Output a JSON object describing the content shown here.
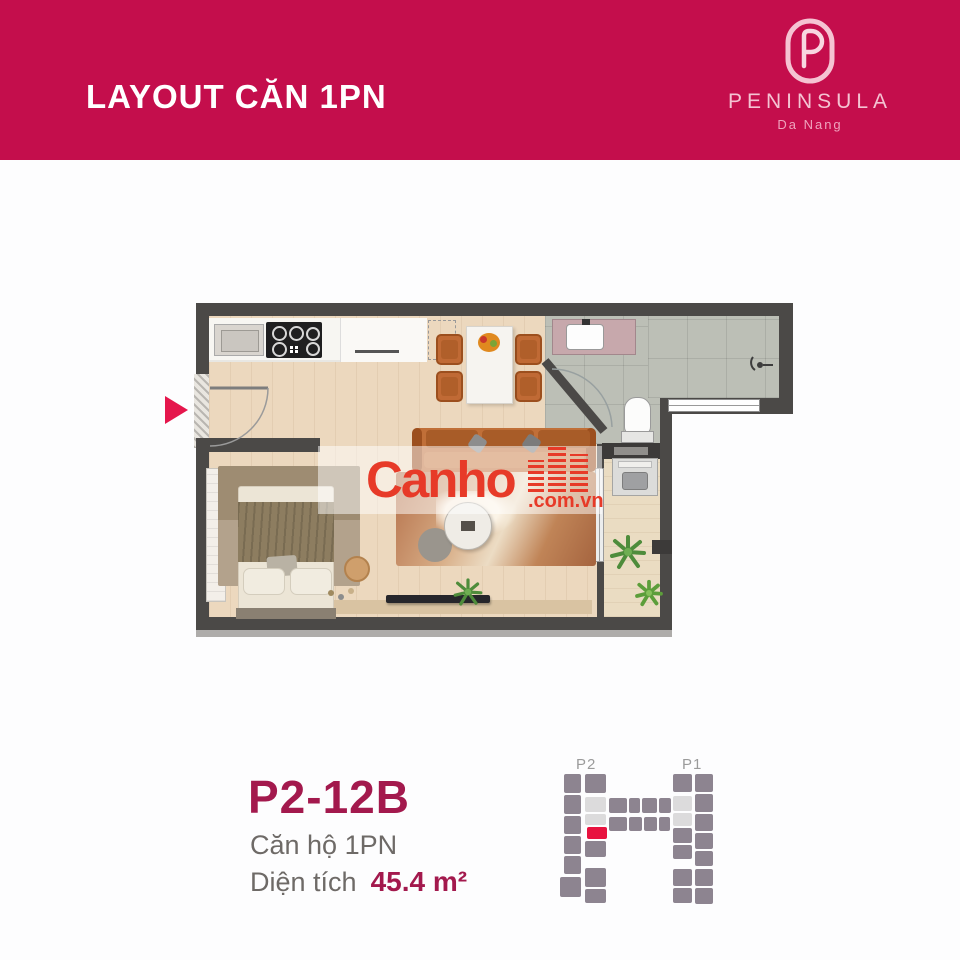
{
  "header": {
    "title": "LAYOUT CĂN 1PN",
    "brand": {
      "name": "PENINSULA",
      "subtitle": "Da Nang"
    }
  },
  "watermark": {
    "brand": "Canho",
    "domain": ".com.vn"
  },
  "unit": {
    "code": "P2-12B",
    "type_label": "Căn hộ 1PN",
    "area_label": "Diện tích",
    "area_value": "45.4 m²"
  },
  "keyplan": {
    "towers": [
      "P2",
      "P1"
    ],
    "blocks": [
      {
        "x": 24,
        "y": 26,
        "w": 17,
        "h": 19,
        "c": "g"
      },
      {
        "x": 24,
        "y": 47,
        "w": 17,
        "h": 19,
        "c": "g"
      },
      {
        "x": 24,
        "y": 68,
        "w": 17,
        "h": 18,
        "c": "g"
      },
      {
        "x": 24,
        "y": 88,
        "w": 17,
        "h": 18,
        "c": "g"
      },
      {
        "x": 24,
        "y": 108,
        "w": 17,
        "h": 18,
        "c": "g"
      },
      {
        "x": 20,
        "y": 129,
        "w": 21,
        "h": 20,
        "c": "g"
      },
      {
        "x": 45,
        "y": 26,
        "w": 21,
        "h": 19,
        "c": "g"
      },
      {
        "x": 45,
        "y": 49,
        "w": 21,
        "h": 15,
        "c": "l"
      },
      {
        "x": 45,
        "y": 66,
        "w": 21,
        "h": 11,
        "c": "l"
      },
      {
        "x": 47,
        "y": 79,
        "w": 20,
        "h": 12,
        "c": "r"
      },
      {
        "x": 45,
        "y": 93,
        "w": 21,
        "h": 16,
        "c": "g"
      },
      {
        "x": 45,
        "y": 120,
        "w": 21,
        "h": 19,
        "c": "g"
      },
      {
        "x": 45,
        "y": 141,
        "w": 21,
        "h": 14,
        "c": "g"
      },
      {
        "x": 69,
        "y": 50,
        "w": 18,
        "h": 15,
        "c": "g"
      },
      {
        "x": 89,
        "y": 50,
        "w": 11,
        "h": 15,
        "c": "g"
      },
      {
        "x": 102,
        "y": 50,
        "w": 15,
        "h": 15,
        "c": "g"
      },
      {
        "x": 119,
        "y": 50,
        "w": 12,
        "h": 15,
        "c": "g"
      },
      {
        "x": 69,
        "y": 69,
        "w": 18,
        "h": 14,
        "c": "g"
      },
      {
        "x": 89,
        "y": 69,
        "w": 13,
        "h": 14,
        "c": "g"
      },
      {
        "x": 104,
        "y": 69,
        "w": 13,
        "h": 14,
        "c": "g"
      },
      {
        "x": 119,
        "y": 69,
        "w": 11,
        "h": 14,
        "c": "g"
      },
      {
        "x": 133,
        "y": 26,
        "w": 19,
        "h": 18,
        "c": "g"
      },
      {
        "x": 133,
        "y": 48,
        "w": 19,
        "h": 15,
        "c": "l"
      },
      {
        "x": 133,
        "y": 65,
        "w": 19,
        "h": 13,
        "c": "l"
      },
      {
        "x": 133,
        "y": 80,
        "w": 19,
        "h": 15,
        "c": "g"
      },
      {
        "x": 133,
        "y": 97,
        "w": 19,
        "h": 14,
        "c": "g"
      },
      {
        "x": 133,
        "y": 121,
        "w": 19,
        "h": 17,
        "c": "g"
      },
      {
        "x": 133,
        "y": 140,
        "w": 19,
        "h": 15,
        "c": "g"
      },
      {
        "x": 155,
        "y": 26,
        "w": 18,
        "h": 18,
        "c": "g"
      },
      {
        "x": 155,
        "y": 46,
        "w": 18,
        "h": 18,
        "c": "g"
      },
      {
        "x": 155,
        "y": 66,
        "w": 18,
        "h": 17,
        "c": "g"
      },
      {
        "x": 155,
        "y": 85,
        "w": 18,
        "h": 16,
        "c": "g"
      },
      {
        "x": 155,
        "y": 103,
        "w": 18,
        "h": 15,
        "c": "g"
      },
      {
        "x": 155,
        "y": 121,
        "w": 18,
        "h": 17,
        "c": "g"
      },
      {
        "x": 155,
        "y": 140,
        "w": 18,
        "h": 16,
        "c": "g"
      }
    ]
  },
  "colors": {
    "band": "#c40e4c",
    "logo_pink": "#f4bfce",
    "accent": "#a3194d",
    "muted": "#6e6a67",
    "marker": "#e5164c",
    "watermark_red": "#e73a28",
    "wall": "#4b4947",
    "keyplan_block": "#8d8490",
    "keyplan_light": "#dcdbdc",
    "keyplan_highlight": "#e8123f"
  }
}
